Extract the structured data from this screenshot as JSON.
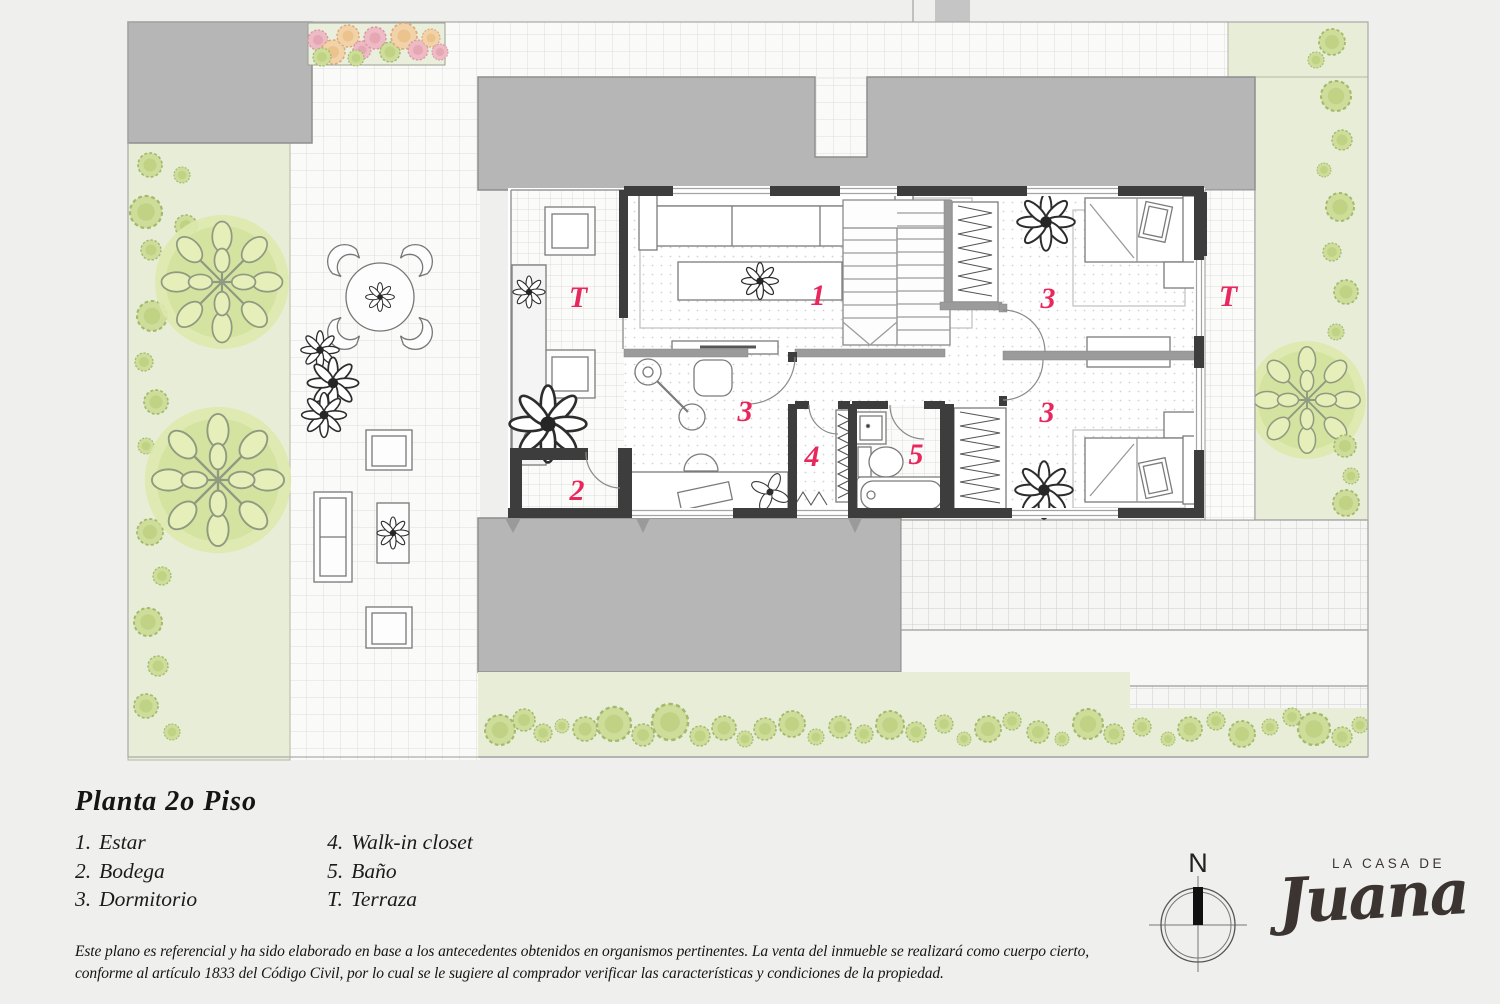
{
  "doc": {
    "title": "Planta  2o Piso",
    "legend": [
      {
        "num": "1.",
        "label": "Estar"
      },
      {
        "num": "2.",
        "label": "Bodega"
      },
      {
        "num": "3.",
        "label": "Dormitorio"
      },
      {
        "num": "4.",
        "label": "Walk-in closet"
      },
      {
        "num": "5.",
        "label": "Baño"
      },
      {
        "num": "T.",
        "label": "Terraza"
      }
    ],
    "disclaimer": "Este plano es referencial y ha sido elaborado en base a los antecedentes obtenidos en organismos pertinentes.  La venta del inmueble se realizará como cuerpo cierto, conforme al artículo 1833 del Código Civil, por lo cual se le sugiere al comprador verificar las características y condiciones de la propiedad."
  },
  "plan": {
    "labels": {
      "terraza_left": "T",
      "estar": "1",
      "bodega": "2",
      "dormitorio_left": "3",
      "walkin": "4",
      "bano": "5",
      "dormitorio_top": "3",
      "dormitorio_bottom": "3",
      "terraza_right": "T"
    },
    "label_color": "#e8285c"
  },
  "compass": {
    "north": "N"
  },
  "brand": {
    "line1": "LA CASA DE",
    "line2": "Juana"
  },
  "colors": {
    "accent_pink": "#e8285c",
    "roof_gray": "#b6b6b6",
    "garden_green": "#e8edd8",
    "wall_dark": "#3d3d3d",
    "background": "#efefee"
  }
}
